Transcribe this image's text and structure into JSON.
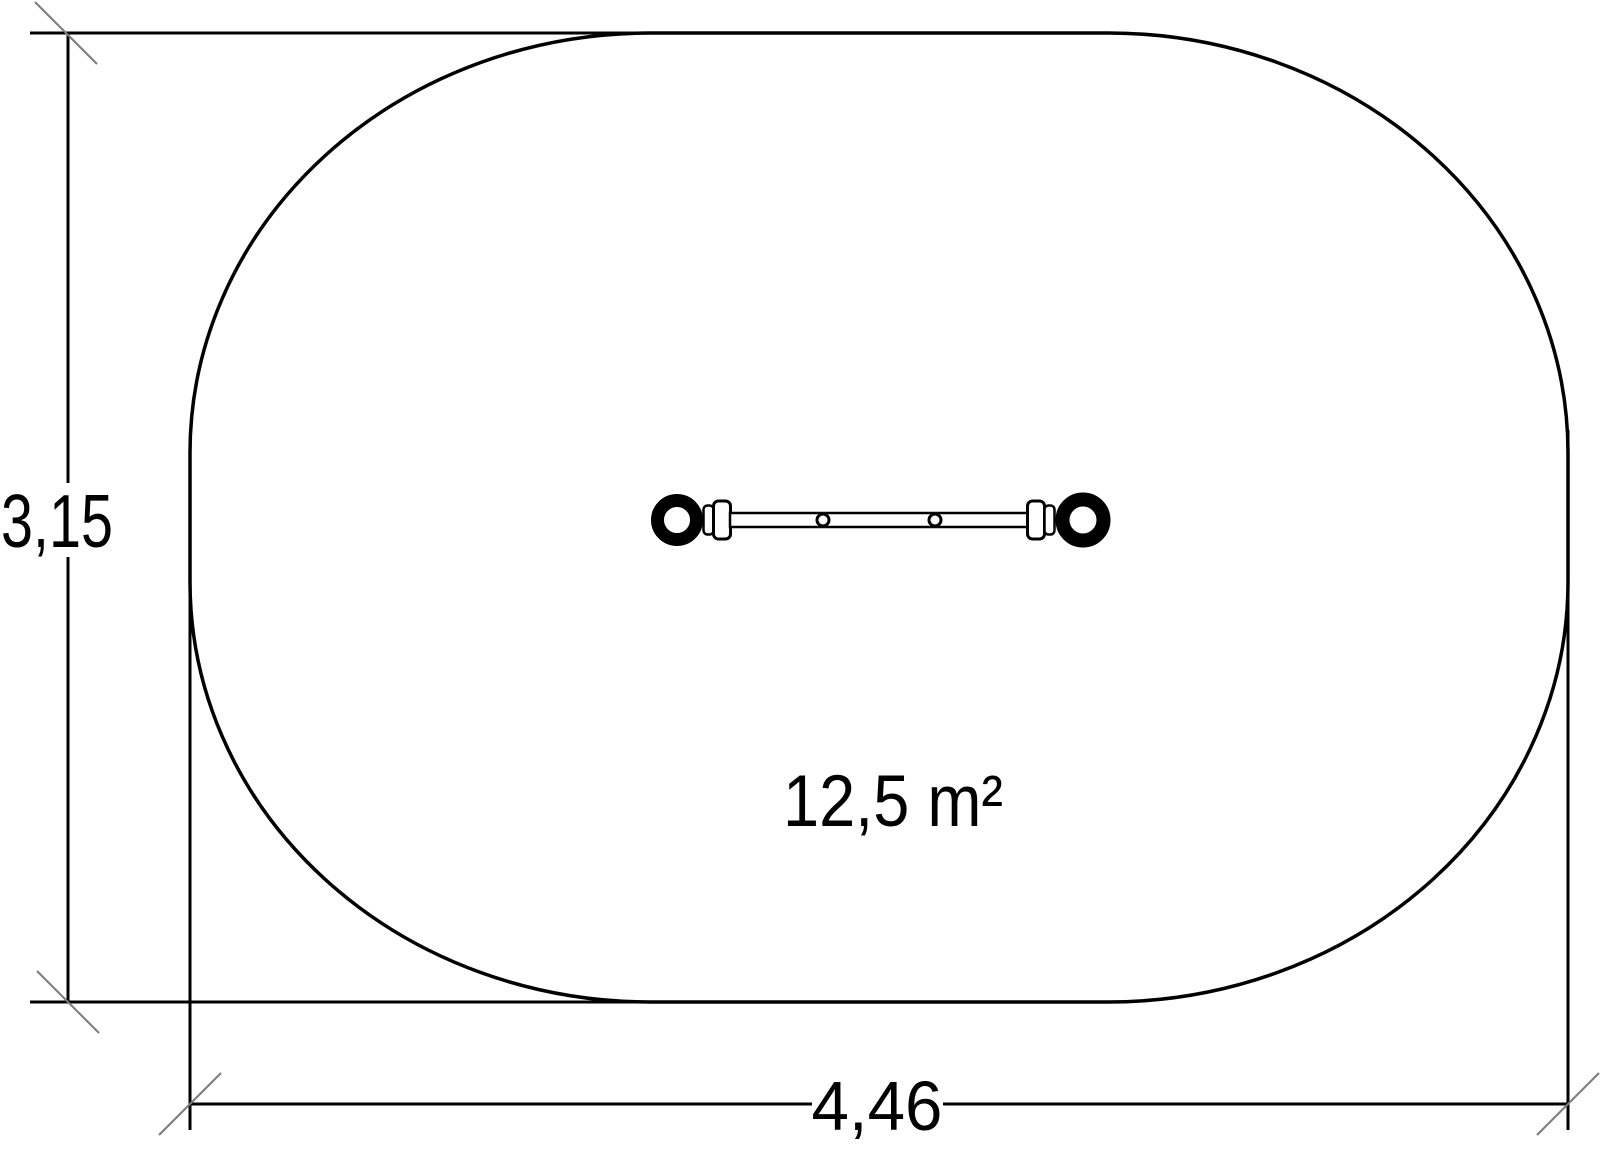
{
  "drawing": {
    "area_label": "12,5 m²",
    "height_dimension_label": "3,15",
    "width_dimension_label": "4,46",
    "colors": {
      "line": "#000000",
      "tick": "#7c7c7c",
      "background": "#ffffff"
    }
  }
}
